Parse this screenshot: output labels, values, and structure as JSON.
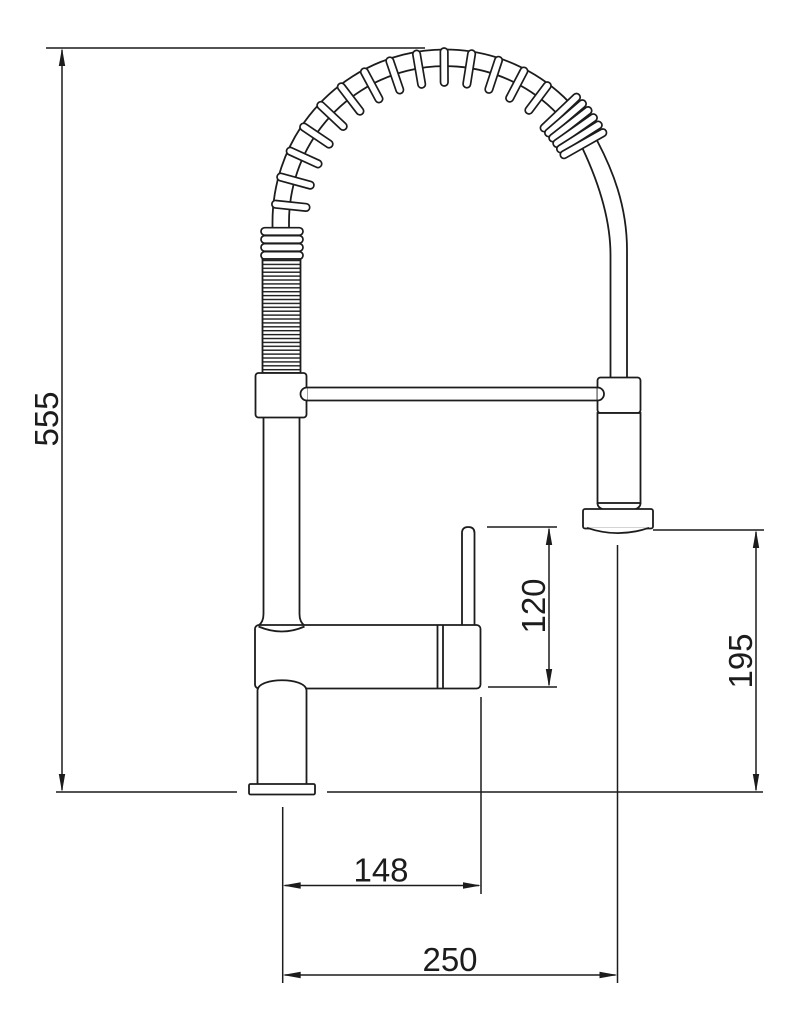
{
  "drawing": {
    "subject": "pull-out-spring-kitchen-faucet-side-view",
    "background_color": "#ffffff",
    "line_color": "#1c1c1c",
    "dimensions": [
      {
        "id": "overall-height",
        "label": "555",
        "orientation": "vertical"
      },
      {
        "id": "handle-to-spout-drop",
        "label": "120",
        "orientation": "vertical"
      },
      {
        "id": "spray-outlet-clearance",
        "label": "195",
        "orientation": "vertical"
      },
      {
        "id": "spout-reach",
        "label": "148",
        "orientation": "horizontal"
      },
      {
        "id": "spray-head-reach",
        "label": "250",
        "orientation": "horizontal"
      }
    ]
  }
}
